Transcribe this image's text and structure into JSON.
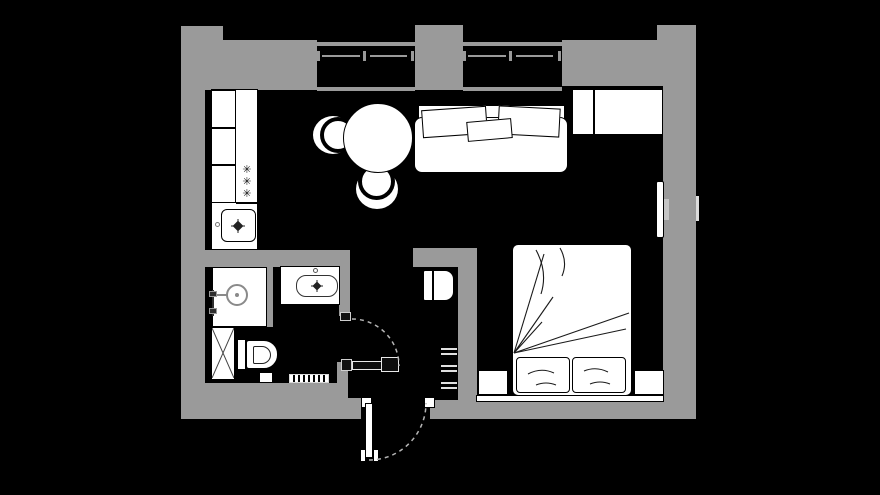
{
  "title": "Studio Apartment Floor Plan",
  "theme": {
    "background": "#000000",
    "wall": "#9a9a9a",
    "floor": "#000000",
    "furniture_fill": "#ffffff",
    "furniture_stroke": "#000000",
    "fixture_stroke": "#8a8a8a",
    "door_dark": "#0d0d0d",
    "door_arc": "#b5b5b5",
    "radiator_line": "#e0e0e0",
    "mount_gray": "#c4c4c4"
  },
  "symbols": {
    "stove_burner": "✳"
  },
  "plan": {
    "windows_count": 2,
    "doors": [
      "entry-door",
      "bathroom-door"
    ],
    "rooms": [
      {
        "name": "kitchen-living-area",
        "furniture": [
          "kitchen-counter",
          "kitchen-cabinets",
          "stove-burners",
          "kitchen-sink",
          "round-dining-table",
          "chair-left",
          "chair-bottom",
          "sofa-with-pillows",
          "wardrobe",
          "wall-tv"
        ]
      },
      {
        "name": "sleeping-area",
        "furniture": [
          "double-bed",
          "bed-pillows",
          "nightstand-left",
          "nightstand-right",
          "bed-bench"
        ]
      },
      {
        "name": "bathroom",
        "furniture": [
          "shower-tray",
          "shower-mixer",
          "washbasin",
          "toilet",
          "washing-machine",
          "trash-bin",
          "bath-mat"
        ]
      },
      {
        "name": "hallway",
        "furniture": [
          "hall-cabinet",
          "radiator"
        ]
      }
    ]
  }
}
